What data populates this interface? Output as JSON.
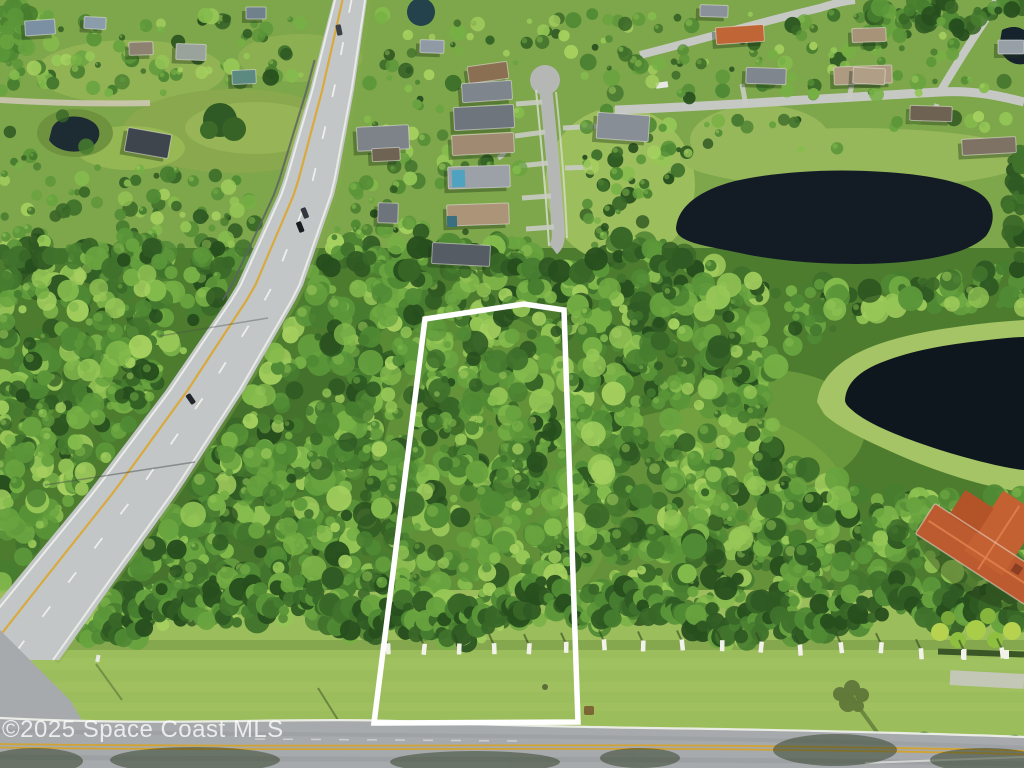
{
  "watermark": {
    "text": "©2025 Space Coast MLS"
  },
  "overlay": {
    "property_boundary_points": "425,319 524,304 564,310 578,722 374,723",
    "boundary_color": "#ffffff"
  },
  "palette": {
    "forest_green": "#47802f",
    "bright_grass": "#a9c661",
    "lake_water": "#131c25",
    "asphalt": "#a7aaac",
    "highway_concrete": "#c2c6c7",
    "center_line_yellow": "#d2a331",
    "roof_terracotta": "#bc5a30",
    "boundary_white": "#ffffff"
  }
}
